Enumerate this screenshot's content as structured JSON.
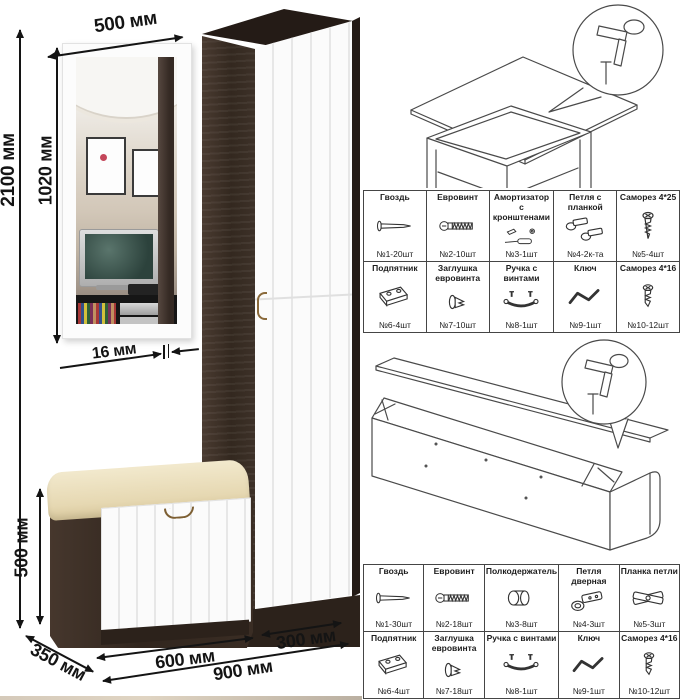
{
  "dimensions": {
    "mirror_width": "500 мм",
    "total_height": "2100 мм",
    "mirror_height": "1020 мм",
    "panel_thickness": "16 мм",
    "bench_height": "500 мм",
    "depth": "350 мм",
    "bench_width": "600 мм",
    "cabinet_width": "300 мм",
    "total_width": "900 мм"
  },
  "colors": {
    "wenge": "#33281f",
    "door_white": "#fbfbfb",
    "cushion_cream": "#e9dcb6",
    "annotation": "#141414"
  },
  "kit1": {
    "items": [
      {
        "name": "Гвоздь",
        "qty": "№1-20шт",
        "icon": "nail"
      },
      {
        "name": "Евровинт",
        "qty": "№2-10шт",
        "icon": "confirmat-screw"
      },
      {
        "name": "Амортизатор с кронштенами",
        "qty": "№3-1шт",
        "icon": "gas-lift"
      },
      {
        "name": "Петля с планкой",
        "qty": "№4-2к-та",
        "icon": "hinge-with-plate"
      },
      {
        "name": "Саморез 4*25",
        "qty": "№5-4шт",
        "icon": "wood-screw"
      },
      {
        "name": "Подпятник",
        "qty": "№6-4шт",
        "icon": "furniture-glide"
      },
      {
        "name": "Заглушка евровинта",
        "qty": "№7-10шт",
        "icon": "screw-cap"
      },
      {
        "name": "Ручка с винтами",
        "qty": "№8-1шт",
        "icon": "handle"
      },
      {
        "name": "Ключ",
        "qty": "№9-1шт",
        "icon": "hex-key"
      },
      {
        "name": "Саморез 4*16",
        "qty": "№10-12шт",
        "icon": "wood-screw"
      }
    ]
  },
  "kit2": {
    "items": [
      {
        "name": "Гвоздь",
        "qty": "№1-30шт",
        "icon": "nail"
      },
      {
        "name": "Евровинт",
        "qty": "№2-18шт",
        "icon": "confirmat-screw"
      },
      {
        "name": "Полкодержатель",
        "qty": "№3-8шт",
        "icon": "shelf-pin"
      },
      {
        "name": "Петля дверная",
        "qty": "№4-3шт",
        "icon": "door-hinge"
      },
      {
        "name": "Планка петли",
        "qty": "№5-3шт",
        "icon": "hinge-plate"
      },
      {
        "name": "Подпятник",
        "qty": "№6-4шт",
        "icon": "furniture-glide"
      },
      {
        "name": "Заглушка евровинта",
        "qty": "№7-18шт",
        "icon": "screw-cap"
      },
      {
        "name": "Ручка с винтами",
        "qty": "№8-1шт",
        "icon": "handle"
      },
      {
        "name": "Ключ",
        "qty": "№9-1шт",
        "icon": "hex-key"
      },
      {
        "name": "Саморез 4*16",
        "qty": "№10-12шт",
        "icon": "wood-screw"
      }
    ]
  }
}
